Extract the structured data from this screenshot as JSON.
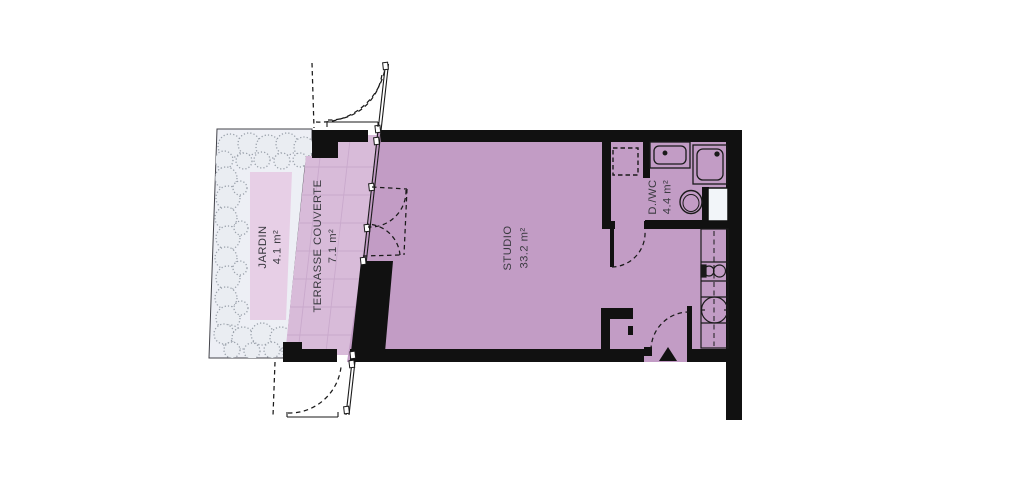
{
  "plan": {
    "rooms": [
      {
        "id": "jardin",
        "name": "JARDIN",
        "area": "4.1 m²"
      },
      {
        "id": "terrasse",
        "name": "TERRASSE COUVERTE",
        "area": "7.1 m²"
      },
      {
        "id": "studio",
        "name": "STUDIO",
        "area": "33.2 m²"
      },
      {
        "id": "dwc",
        "name": "D./WC",
        "area": "4.4 m²"
      }
    ],
    "colors": {
      "background": "#ffffff",
      "plot": "#edeff5",
      "hedge": "#99a0aa",
      "hedge_fill": "#eaedf2",
      "garden": "#e7cfe6",
      "terrace": "#d8bbd9",
      "grid": "#c9a9cc",
      "studio": "#c29cc5",
      "wall": "#111111",
      "shaft": "#f2f5f9",
      "label": "#3a3a40"
    },
    "icons": [
      "washing-machine-slot-icon",
      "washbasin-icon",
      "shower-icon",
      "toilet-icon",
      "duct-shaft-icon",
      "kitchen-counter-icon",
      "kitchen-sink-icon",
      "cooktop-icon",
      "entrance-arrow-icon",
      "door-swing-icon",
      "glazed-facade-icon",
      "hedge-icon"
    ]
  }
}
